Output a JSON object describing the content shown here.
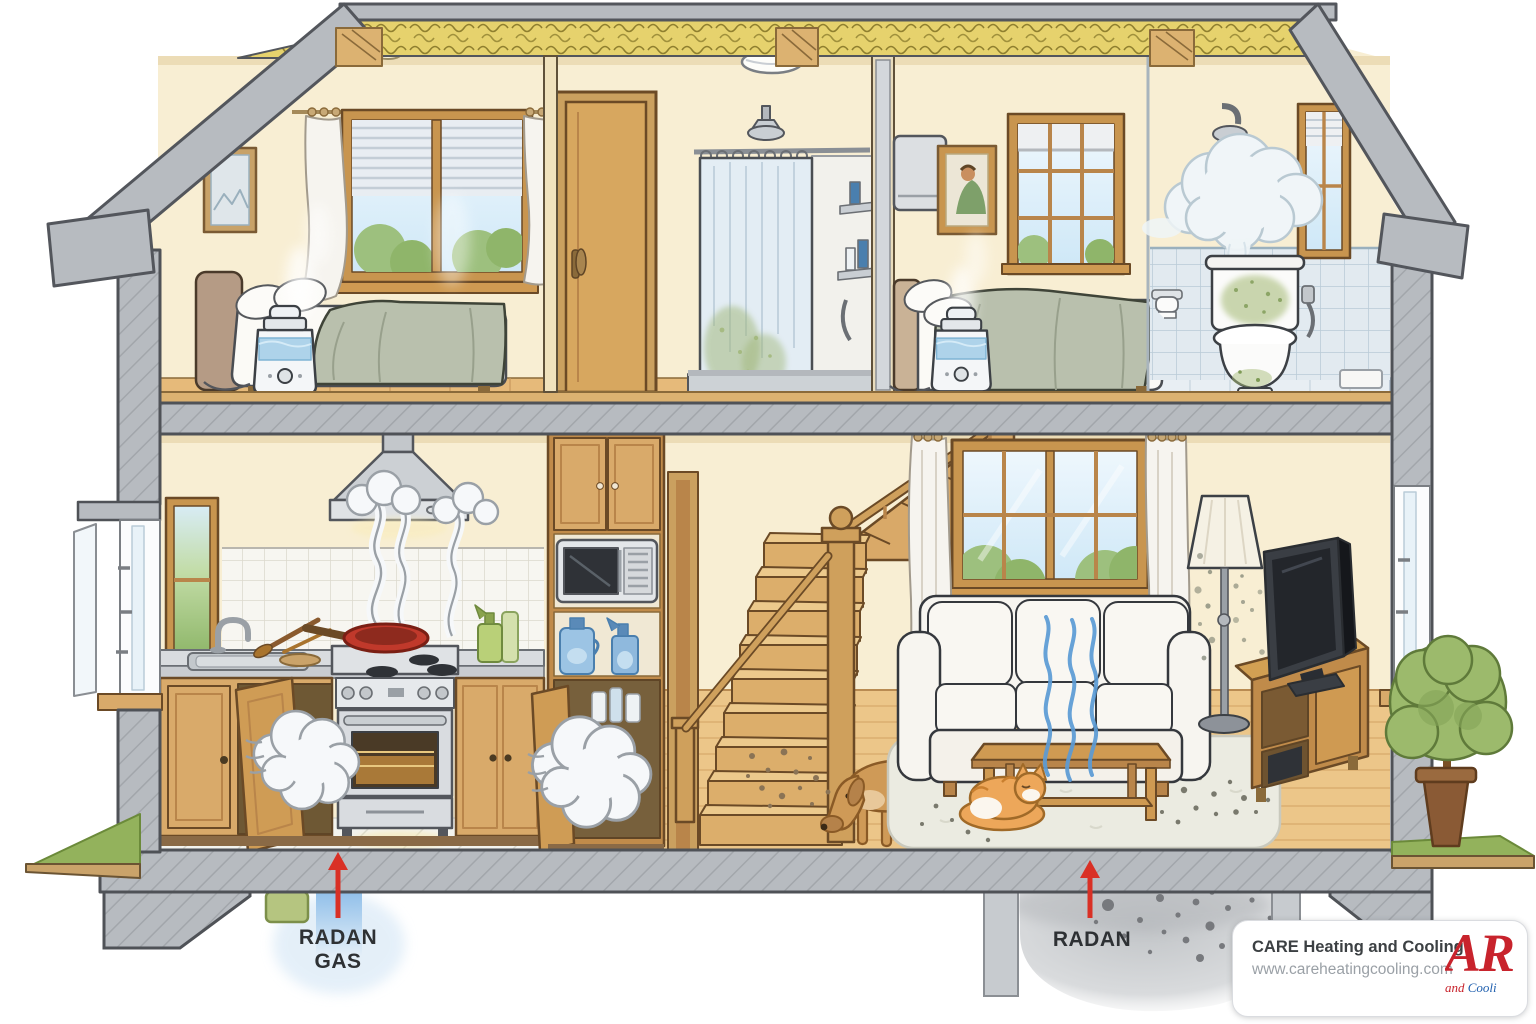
{
  "scene": {
    "kind": "house-cutaway-indoor-air-quality-illustration"
  },
  "labels": {
    "radon_gas": {
      "line1": "RADAN",
      "line2": "GAS"
    },
    "radon": {
      "label": "RADAN"
    }
  },
  "logo_card": {
    "company": "CARE Heating and Cooling",
    "website": "www.careheatingcooling.com",
    "logo_large": "AR",
    "logo_small_red": "and",
    "logo_small_blue": "Cooli"
  },
  "colors": {
    "radon_arrow_red": "#d93025",
    "radon_gas_blue": "#8bbce8",
    "voc_line_blue": "#5b9bd5",
    "concrete_gray": "#b7bbc0",
    "insulation_yellow": "#e6d26d",
    "wall_cream": "#f8eed3",
    "wood_tan": "#d9aa6a",
    "mold_green": "#a9bd7c",
    "logo_red": "#c8232c",
    "logo_blue": "#1f5fae"
  }
}
